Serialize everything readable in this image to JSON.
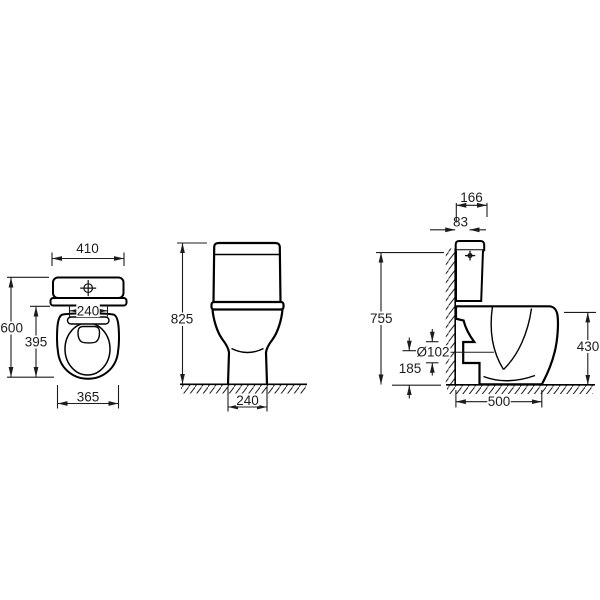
{
  "diagram": {
    "type": "technical-dimension-drawing",
    "subject": "close-coupled toilet (3 orthographic views)",
    "colors": {
      "line": "#000000",
      "dimension": "#1c1c1c",
      "background": "#ffffff"
    },
    "views": {
      "top": {
        "label": "top view",
        "dims": {
          "tank_width": "410",
          "hinge_spacing": "240",
          "overall_depth": "600",
          "seat_length": "395",
          "seat_width": "365"
        }
      },
      "front": {
        "label": "front view",
        "dims": {
          "overall_height": "825",
          "foot_width": "240"
        }
      },
      "side": {
        "label": "side view",
        "dims": {
          "tank_depth": "166",
          "button_offset": "83",
          "height_at_wall": "755",
          "outlet_diameter": "Ø102",
          "outlet_axis_height": "185",
          "rim_height": "430",
          "overall_depth": "500"
        }
      }
    }
  }
}
